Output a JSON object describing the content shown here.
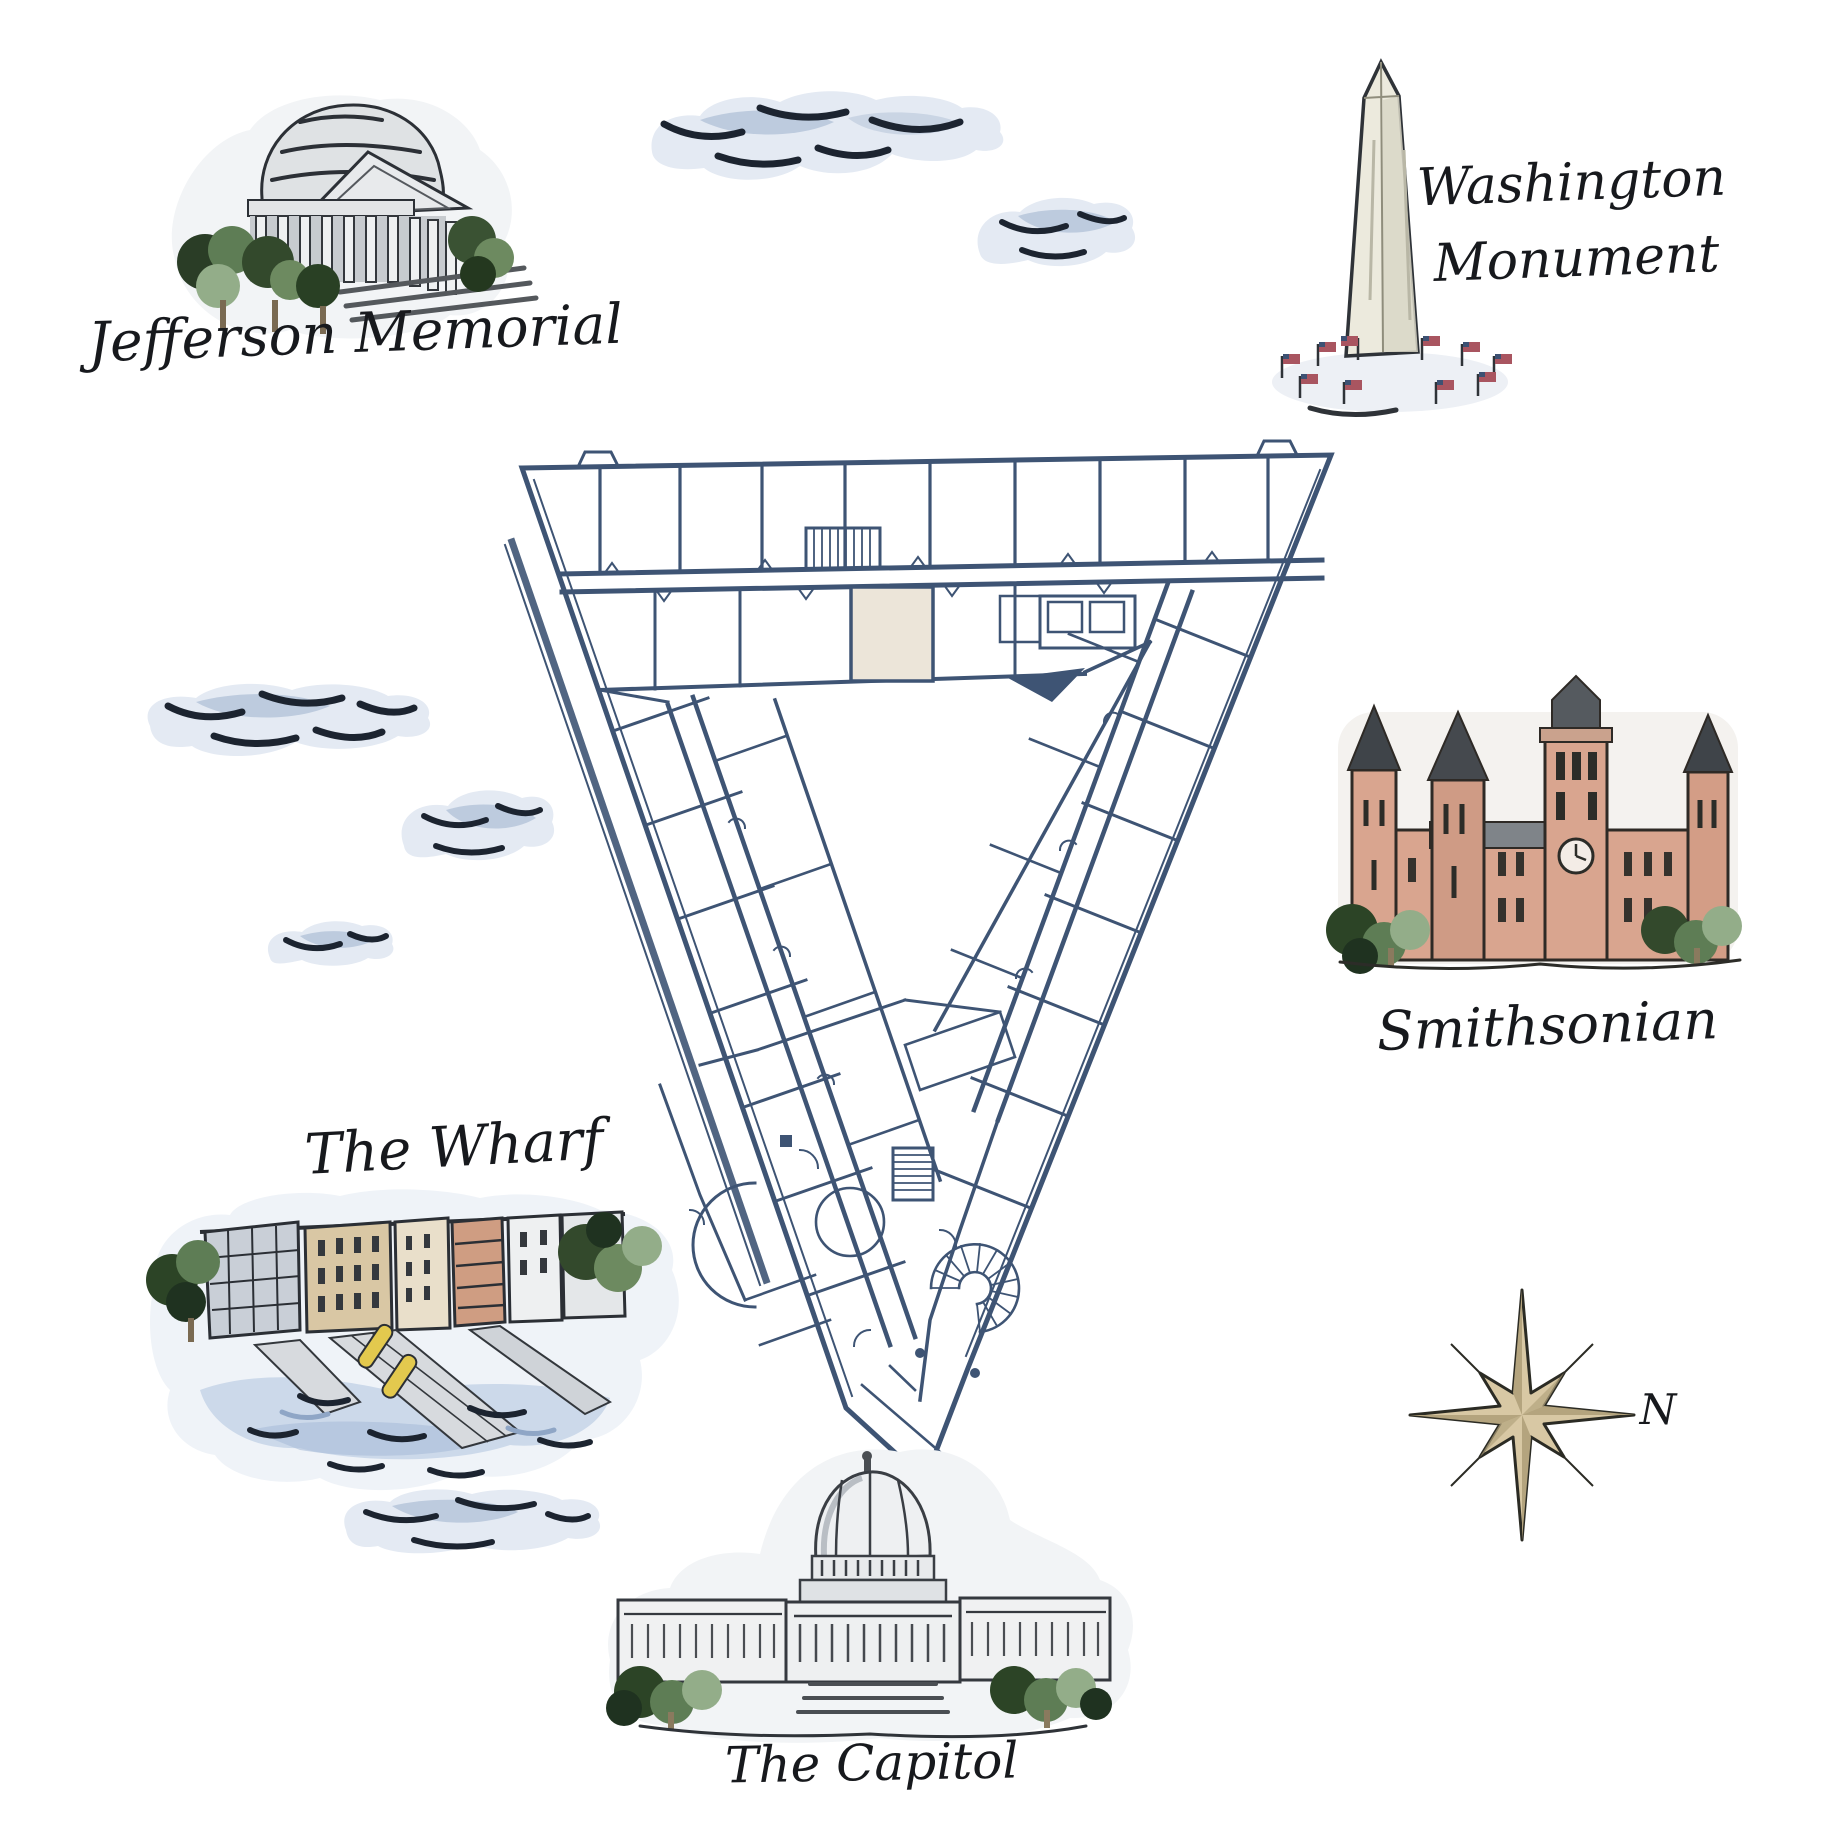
{
  "map": {
    "theme": "Washington DC landmarks watercolor map with triangular venue floor plan"
  },
  "labels": {
    "jefferson_memorial": "Jefferson Memorial",
    "washington_monument_line1": "Washington",
    "washington_monument_line2": "Monument",
    "smithsonian": "Smithsonian",
    "the_wharf": "The Wharf",
    "the_capitol": "The Capitol",
    "compass_north": "N"
  },
  "landmarks": [
    {
      "id": "jefferson-memorial",
      "label": "Jefferson Memorial"
    },
    {
      "id": "washington-monument",
      "label": "Washington Monument"
    },
    {
      "id": "smithsonian",
      "label": "Smithsonian"
    },
    {
      "id": "the-wharf",
      "label": "The Wharf"
    },
    {
      "id": "the-capitol",
      "label": "The Capitol"
    }
  ],
  "floor_plan": {
    "shape": "triangular building with central courtyard",
    "line_color": "#3e5474",
    "highlight_room_color": "#ece5d9"
  },
  "palette": {
    "ink": "#1c2430",
    "cloud_base": "#e4eaf3",
    "cloud_shade": "#9db1cc",
    "stone_light": "#eef0f1",
    "stone_shade": "#d3d7db",
    "castle_salmon": "#d9a58f",
    "roof_dark": "#3f4449",
    "tree_dark": "#24381f",
    "tree_mid": "#5d7d52",
    "tree_light": "#9cb894",
    "compass_gold": "#d8c8a4",
    "water_blue": "#ccd9ea",
    "kayak_yellow": "#e3c94e",
    "flag_red": "#a95560",
    "flag_blue": "#3d5173",
    "monument_stone": "#eceadd"
  }
}
